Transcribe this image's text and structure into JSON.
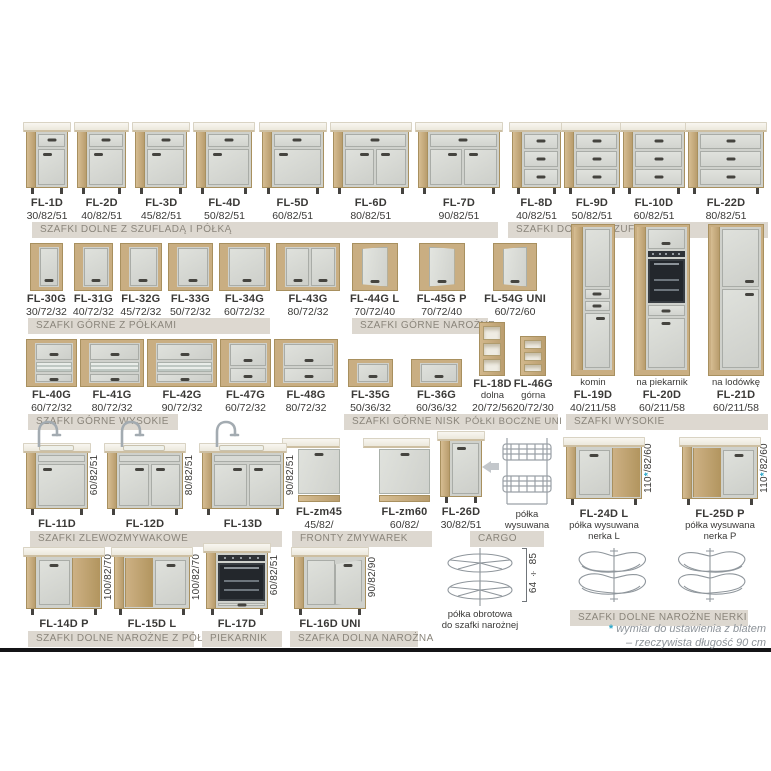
{
  "colors": {
    "accent_asterisk": "#2ba7c9",
    "wood": "#c9ae82",
    "front": "#d7d9d4",
    "counter": "#f3f0e8",
    "section_bar": "#ddd8d0",
    "section_text": "#8a857b",
    "text": "#3a3937",
    "divider": "#141416"
  },
  "footnote": {
    "asterisk": "*",
    "line1": " wymiar do ustawienia z blatem",
    "line2": "– rzeczywista długość 90 cm"
  },
  "sections": [
    {
      "title": "SZAFKI DOLNE Z SZUFLADĄ I PÓŁKĄ",
      "items": [
        {
          "type": "base-dd",
          "cm": 30,
          "lines": [
            {
              "t": "FL-1D",
              "k": "code"
            },
            {
              "t": "30/82/51",
              "k": "dims"
            }
          ]
        },
        {
          "type": "base-dd",
          "cm": 40,
          "lines": [
            {
              "t": "FL-2D",
              "k": "code"
            },
            {
              "t": "40/82/51",
              "k": "dims"
            }
          ]
        },
        {
          "type": "base-dd",
          "cm": 45,
          "lines": [
            {
              "t": "FL-3D",
              "k": "code"
            },
            {
              "t": "45/82/51",
              "k": "dims"
            }
          ]
        },
        {
          "type": "base-dd",
          "cm": 50,
          "lines": [
            {
              "t": "FL-4D",
              "k": "code"
            },
            {
              "t": "50/82/51",
              "k": "dims"
            }
          ]
        },
        {
          "type": "base-dd",
          "cm": 60,
          "lines": [
            {
              "t": "FL-5D",
              "k": "code"
            },
            {
              "t": "60/82/51",
              "k": "dims"
            }
          ]
        },
        {
          "type": "base-dd2",
          "cm": 80,
          "lines": [
            {
              "t": "FL-6D",
              "k": "code"
            },
            {
              "t": "80/82/51",
              "k": "dims"
            }
          ]
        },
        {
          "type": "base-dd2",
          "cm": 90,
          "lines": [
            {
              "t": "FL-7D",
              "k": "code"
            },
            {
              "t": "90/82/51",
              "k": "dims"
            }
          ]
        }
      ]
    },
    {
      "title": "SZAFKI DOLNE Z SZUFLADAMI",
      "items": [
        {
          "type": "base-3dr",
          "cm": 40,
          "lines": [
            {
              "t": "FL-8D",
              "k": "code"
            },
            {
              "t": "40/82/51",
              "k": "dims"
            }
          ]
        },
        {
          "type": "base-3dr",
          "cm": 50,
          "lines": [
            {
              "t": "FL-9D",
              "k": "code"
            },
            {
              "t": "50/82/51",
              "k": "dims"
            }
          ]
        },
        {
          "type": "base-3dr",
          "cm": 60,
          "lines": [
            {
              "t": "FL-10D",
              "k": "code"
            },
            {
              "t": "60/82/51",
              "k": "dims"
            }
          ]
        },
        {
          "type": "base-3dr",
          "cm": 80,
          "lines": [
            {
              "t": "FL-22D",
              "k": "code"
            },
            {
              "t": "80/82/51",
              "k": "dims"
            }
          ]
        }
      ]
    },
    {
      "title": "SZAFKI GÓRNE Z PÓŁKAMI",
      "items": [
        {
          "type": "wall-1d",
          "cm": 30,
          "lines": [
            {
              "t": "FL-30G",
              "k": "code"
            },
            {
              "t": "30/72/32",
              "k": "dims"
            }
          ]
        },
        {
          "type": "wall-1d",
          "cm": 40,
          "lines": [
            {
              "t": "FL-31G",
              "k": "code"
            },
            {
              "t": "40/72/32",
              "k": "dims"
            }
          ]
        },
        {
          "type": "wall-1d",
          "cm": 45,
          "lines": [
            {
              "t": "FL-32G",
              "k": "code"
            },
            {
              "t": "45/72/32",
              "k": "dims"
            }
          ]
        },
        {
          "type": "wall-1d",
          "cm": 50,
          "lines": [
            {
              "t": "FL-33G",
              "k": "code"
            },
            {
              "t": "50/72/32",
              "k": "dims"
            }
          ]
        },
        {
          "type": "wall-1d",
          "cm": 60,
          "lines": [
            {
              "t": "FL-34G",
              "k": "code"
            },
            {
              "t": "60/72/32",
              "k": "dims"
            }
          ]
        },
        {
          "type": "wall-2d",
          "cm": 80,
          "lines": [
            {
              "t": "FL-43G",
              "k": "code"
            },
            {
              "t": "80/72/32",
              "k": "dims"
            }
          ]
        }
      ]
    },
    {
      "title": "SZAFKI GÓRNE NAROŻNE",
      "items": [
        {
          "type": "wall-corner",
          "cm": 70,
          "lines": [
            {
              "t": "FL-44G L",
              "k": "code"
            },
            {
              "t": "70/72/40",
              "k": "dims"
            }
          ]
        },
        {
          "type": "wall-corner",
          "cm": 70,
          "mirror": true,
          "lines": [
            {
              "t": "FL-45G P",
              "k": "code"
            },
            {
              "t": "70/72/40",
              "k": "dims"
            }
          ]
        },
        {
          "type": "wall-corner",
          "cm": 60,
          "lines": [
            {
              "t": "FL-54G UNI",
              "k": "code"
            },
            {
              "t": "60/72/60",
              "k": "dims"
            }
          ]
        }
      ]
    },
    {
      "title": "SZAFKI GÓRNE WYSOKIE",
      "items": [
        {
          "type": "wall-glass",
          "cm": 60,
          "lines": [
            {
              "t": "FL-40G",
              "k": "code"
            },
            {
              "t": "60/72/32",
              "k": "dims"
            }
          ]
        },
        {
          "type": "wall-glass",
          "cm": 80,
          "lines": [
            {
              "t": "FL-41G",
              "k": "code"
            },
            {
              "t": "80/72/32",
              "k": "dims"
            }
          ]
        },
        {
          "type": "wall-glass",
          "cm": 90,
          "lines": [
            {
              "t": "FL-42G",
              "k": "code"
            },
            {
              "t": "90/72/32",
              "k": "dims"
            }
          ]
        },
        {
          "type": "wall-flap",
          "cm": 60,
          "lines": [
            {
              "t": "FL-47G",
              "k": "code"
            },
            {
              "t": "60/72/32",
              "k": "dims"
            }
          ]
        },
        {
          "type": "wall-flap",
          "cm": 80,
          "lines": [
            {
              "t": "FL-48G",
              "k": "code"
            },
            {
              "t": "80/72/32",
              "k": "dims"
            }
          ]
        }
      ]
    },
    {
      "title": "SZAFKI GÓRNE NISKIE",
      "items": [
        {
          "type": "wall-low",
          "cm": 50,
          "lines": [
            {
              "t": "FL-35G",
              "k": "code"
            },
            {
              "t": "50/36/32",
              "k": "dims"
            }
          ]
        },
        {
          "type": "wall-low",
          "cm": 60,
          "lines": [
            {
              "t": "FL-36G",
              "k": "code"
            },
            {
              "t": "60/36/32",
              "k": "dims"
            }
          ]
        }
      ]
    },
    {
      "title": "PÓŁKI BOCZNE UNI",
      "items": [
        {
          "type": "side-shelf",
          "cm": 20,
          "lines": [
            {
              "t": "FL-18D",
              "k": "code"
            },
            {
              "t": "dolna",
              "k": "small"
            },
            {
              "t": "20/72/56",
              "k": "dims"
            }
          ]
        },
        {
          "type": "side-shelf",
          "cm": 20,
          "lines": [
            {
              "t": "FL-46G",
              "k": "code"
            },
            {
              "t": "górna",
              "k": "small"
            },
            {
              "t": "20/72/30",
              "k": "dims"
            }
          ]
        }
      ]
    },
    {
      "title": "SZAFKI WYSOKIE",
      "items": [
        {
          "type": "tall-komin",
          "cm": 40,
          "lines": [
            {
              "t": "komin",
              "k": "small"
            },
            {
              "t": "FL-19D",
              "k": "code"
            },
            {
              "t": "40/211/58",
              "k": "dims"
            }
          ]
        },
        {
          "type": "tall-oven",
          "cm": 60,
          "lines": [
            {
              "t": "na piekarnik",
              "k": "small"
            },
            {
              "t": "FL-20D",
              "k": "code"
            },
            {
              "t": "60/211/58",
              "k": "dims"
            }
          ]
        },
        {
          "type": "tall-fridge",
          "cm": 60,
          "lines": [
            {
              "t": "na lodówkę",
              "k": "small"
            },
            {
              "t": "FL-21D",
              "k": "code"
            },
            {
              "t": "60/211/58",
              "k": "dims"
            }
          ]
        }
      ]
    },
    {
      "title": "SZAFKI ZLEWOZMYWAKOWE",
      "items": [
        {
          "type": "sink-1",
          "cm": 60,
          "vdim": "60/82/51",
          "lines": [
            {
              "t": "FL-11D",
              "k": "code"
            }
          ]
        },
        {
          "type": "sink-2",
          "cm": 80,
          "vdim": "80/82/51",
          "lines": [
            {
              "t": "FL-12D",
              "k": "code"
            }
          ]
        },
        {
          "type": "sink-2",
          "cm": 90,
          "vdim": "90/82/51",
          "lines": [
            {
              "t": "FL-13D",
              "k": "code"
            }
          ]
        }
      ]
    },
    {
      "title": "FRONTY ZMYWAREK",
      "items": [
        {
          "type": "dw-front",
          "cm": 45,
          "lines": [
            {
              "t": "FL-zm45",
              "k": "code"
            },
            {
              "t": "45/82/",
              "k": "dims"
            }
          ]
        },
        {
          "type": "dw-front",
          "cm": 60,
          "lines": [
            {
              "t": "FL-zm60",
              "k": "code"
            },
            {
              "t": "60/82/",
              "k": "dims"
            }
          ]
        }
      ]
    },
    {
      "title": "CARGO",
      "items": [
        {
          "type": "base-1d",
          "cm": 30,
          "lines": [
            {
              "t": "FL-26D",
              "k": "code"
            },
            {
              "t": "30/82/51",
              "k": "dims"
            }
          ]
        },
        {
          "type": "arrow-left"
        },
        {
          "type": "cargo-basket",
          "lines": [
            {
              "t": "półka",
              "k": "small"
            },
            {
              "t": "wysuwana",
              "k": "small"
            }
          ]
        }
      ]
    },
    {
      "title": "SZAFKI DOLNE NAROŻNE NERKI",
      "items": [
        {
          "type": "corner-base",
          "cm": 110,
          "vdim": "110*/82/60",
          "lines": [
            {
              "t": "FL-24D L",
              "k": "code"
            },
            {
              "t": "półka wysuwana",
              "k": "small"
            },
            {
              "t": "nerka L",
              "k": "small"
            }
          ]
        },
        {
          "type": "corner-base",
          "cm": 110,
          "mirror": true,
          "vdim": "110*/82/60",
          "lines": [
            {
              "t": "FL-25D P",
              "k": "code"
            },
            {
              "t": "półka wysuwana",
              "k": "small"
            },
            {
              "t": "nerka P",
              "k": "small"
            }
          ]
        }
      ],
      "items2": [
        {
          "type": "nerka-shelf"
        },
        {
          "type": "nerka-shelf",
          "mirror": true
        }
      ]
    },
    {
      "title": "SZAFKI DOLNE NAROŻNE Z PÓŁKĄ",
      "items": [
        {
          "type": "corner-base",
          "cm": 100,
          "vdim": "100/82/70",
          "lines": [
            {
              "t": "FL-14D P",
              "k": "code"
            }
          ]
        },
        {
          "type": "corner-base",
          "cm": 100,
          "mirror": true,
          "vdim": "100/82/70",
          "lines": [
            {
              "t": "FL-15D L",
              "k": "code"
            }
          ]
        }
      ]
    },
    {
      "title": "PIEKARNIK",
      "items": [
        {
          "type": "oven-base",
          "cm": 60,
          "vdim": "60/82/51",
          "lines": [
            {
              "t": "FL-17D",
              "k": "code"
            }
          ]
        }
      ]
    },
    {
      "title": "SZAFKA DOLNA NAROŻNA",
      "items": [
        {
          "type": "corner-base-v",
          "cm": 90,
          "vdim": "90/82/90",
          "lines": [
            {
              "t": "FL-16D UNI",
              "k": "code"
            }
          ]
        },
        {
          "type": "carousel",
          "vdim": "64 ÷ 85",
          "vline": true,
          "lines": [
            {
              "t": "półka obrotowa",
              "k": "small"
            },
            {
              "t": "do szafki narożnej",
              "k": "small"
            }
          ]
        }
      ]
    }
  ]
}
